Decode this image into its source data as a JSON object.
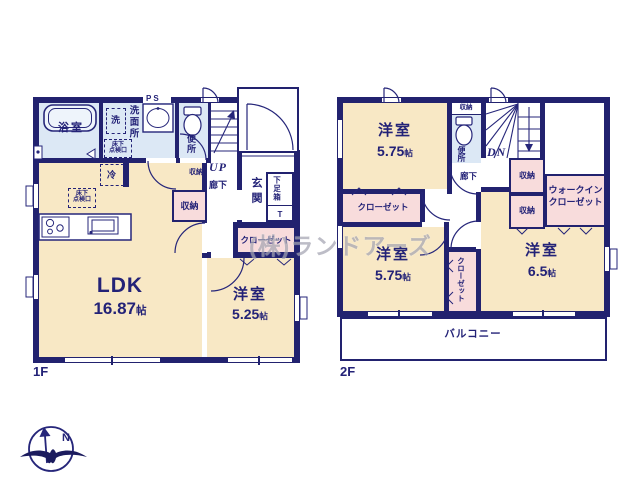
{
  "watermark": "(株)ランドアーズ",
  "compass": {
    "label": "N"
  },
  "colors": {
    "wall": "#22226f",
    "text": "#232277",
    "cream": "#f8e8c5",
    "blue": "#dce8f5",
    "pink": "#f8dcdc",
    "line": "#2a2a7a",
    "watermark": "#a5a5b2"
  },
  "floor1": {
    "floor_label": "1F",
    "bathroom": {
      "label": "浴室"
    },
    "washroom": {
      "label": "洗面所",
      "washer": "洗",
      "ps": "PS",
      "hatch_line1": "床下",
      "hatch_line2": "点検口"
    },
    "toilet": {
      "label": "便所"
    },
    "stairs": {
      "label": "UP"
    },
    "understairs_storage": {
      "label": "収納"
    },
    "hallway": {
      "label": "廊下"
    },
    "entrance": {
      "label": "玄関"
    },
    "shoebox": {
      "label": "下足箱",
      "t": "T"
    },
    "storage": {
      "label": "収納"
    },
    "closet": {
      "label": "クローゼット"
    },
    "ldk": {
      "name": "LDK",
      "size": "16.87",
      "unit": "帖",
      "fridge": "冷",
      "hatch_line1": "床下",
      "hatch_line2": "点検口"
    },
    "bedroom": {
      "name": "洋室",
      "size": "5.25",
      "unit": "帖"
    }
  },
  "floor2": {
    "floor_label": "2F",
    "bedroom_nw": {
      "name": "洋室",
      "size": "5.75",
      "unit": "帖"
    },
    "closet_nw": {
      "label": "クローゼット"
    },
    "toilet": {
      "label": "便所",
      "storage": "収納"
    },
    "stairs": {
      "label": "DN"
    },
    "hallway": {
      "label": "廊下"
    },
    "storage_a": {
      "label": "収納"
    },
    "storage_b": {
      "label": "収納"
    },
    "wic": {
      "line1": "ウォークイン",
      "line2": "クローゼット"
    },
    "bedroom_sw": {
      "name": "洋室",
      "size": "5.75",
      "unit": "帖"
    },
    "closet_mid": {
      "label": "クローゼット"
    },
    "bedroom_se": {
      "name": "洋室",
      "size": "6.5",
      "unit": "帖"
    },
    "balcony": {
      "label": "バルコニー"
    }
  }
}
